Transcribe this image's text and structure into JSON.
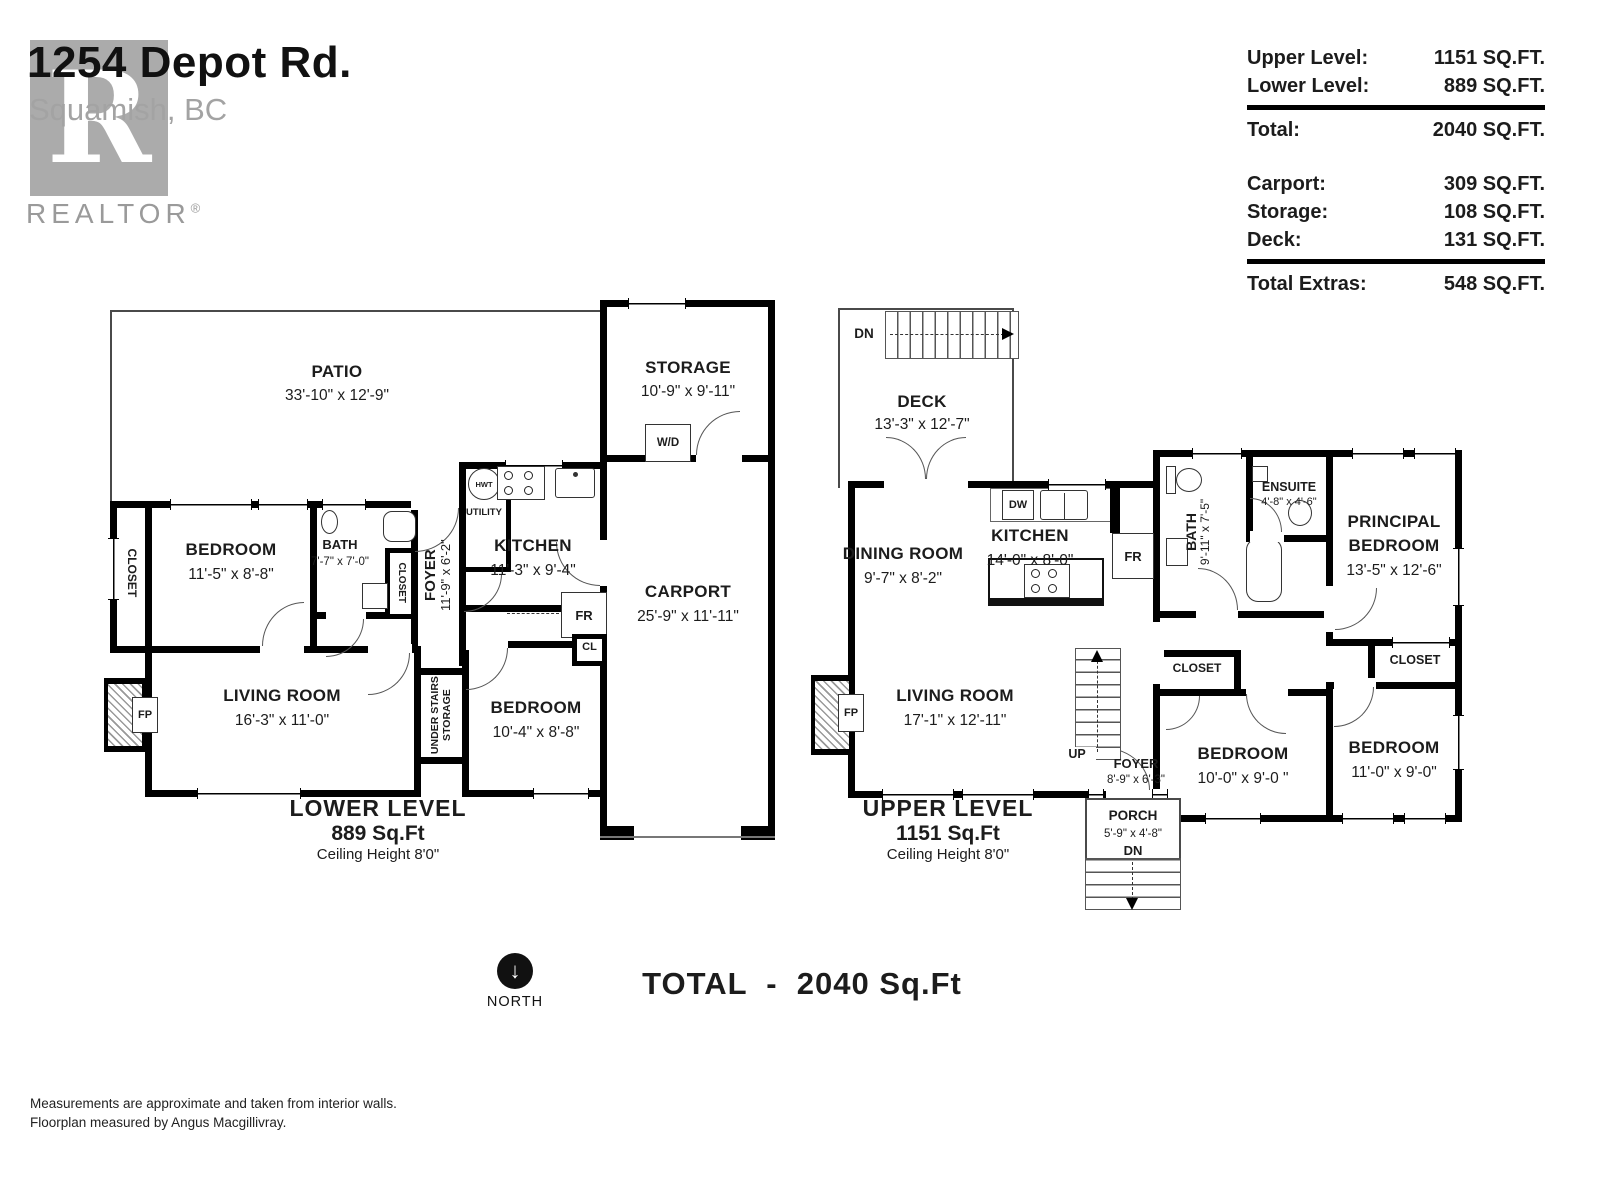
{
  "header": {
    "address_line1": "1254 Depot Rd.",
    "address_line2": "Squamish, BC",
    "logo_letter": "R",
    "realtor_label": "REALTOR",
    "registered_mark": "®"
  },
  "summary": {
    "rows": [
      {
        "label": "Upper Level:",
        "value": "1151 SQ.FT."
      },
      {
        "label": "Lower Level:",
        "value": "889 SQ.FT."
      },
      {
        "label": "Total:",
        "value": "2040 SQ.FT."
      },
      {
        "label": "Carport:",
        "value": "309 SQ.FT."
      },
      {
        "label": "Storage:",
        "value": "108 SQ.FT."
      },
      {
        "label": "Deck:",
        "value": "131 SQ.FT."
      },
      {
        "label": "Total Extras:",
        "value": "548 SQ.FT."
      }
    ]
  },
  "lower": {
    "title": "LOWER LEVEL",
    "sqft": "889 Sq.Ft",
    "ceiling": "Ceiling Height 8'0\"",
    "patio": {
      "name": "PATIO",
      "dims": "33'-10\" x 12'-9\""
    },
    "storage": {
      "name": "STORAGE",
      "dims": "10'-9\" x 9'-11\""
    },
    "wd": "W/D",
    "closet_left": "CLOSET",
    "bedroom1": {
      "name": "BEDROOM",
      "dims": "11'-5\" x 8'-8\""
    },
    "bath": {
      "name": "BATH",
      "dims": "7'-7\" x 7'-0\""
    },
    "closet_small": "CLOSET",
    "foyer": {
      "name": "FOYER",
      "dims": "11'-9\" x 6'-2\""
    },
    "utility": {
      "name": "UTILITY",
      "hwt": "HWT"
    },
    "kitchen": {
      "name": "KITCHEN",
      "dims": "11'-3\" x 9'-4\""
    },
    "carport": {
      "name": "CARPORT",
      "dims": "25'-9\" x 11'-11\""
    },
    "living": {
      "name": "LIVING ROOM",
      "dims": "16'-3\" x 11'-0\""
    },
    "fp": "FP",
    "understairs_line1": "UNDER STAIRS",
    "understairs_line2": "STORAGE",
    "bedroom2": {
      "name": "BEDROOM",
      "dims": "10'-4\" x 8'-8\""
    },
    "fr": "FR",
    "cl": "CL"
  },
  "upper": {
    "title": "UPPER LEVEL",
    "sqft": "1151 Sq.Ft",
    "ceiling": "Ceiling Height 8'0\"",
    "deck": {
      "name": "DECK",
      "dims": "13'-3\" x 12'-7\"",
      "dn": "DN"
    },
    "dining": {
      "name": "DINING ROOM",
      "dims": "9'-7\" x 8'-2\""
    },
    "kitchen": {
      "name": "KITCHEN",
      "dims": "14'-0\" x 8'-0\"",
      "dw": "DW",
      "fr": "FR"
    },
    "bath": {
      "name": "BATH",
      "dims": "9'-11\" x 7'-5\""
    },
    "ensuite": {
      "name": "ENSUITE",
      "dims": "4'-8\" x 4'-6\""
    },
    "principal": {
      "name_line1": "PRINCIPAL",
      "name_line2": "BEDROOM",
      "dims": "13'-5\" x 12'-6\""
    },
    "living": {
      "name": "LIVING ROOM",
      "dims": "17'-1\" x 12'-11\""
    },
    "fp": "FP",
    "stairs_up": "UP",
    "foyer": {
      "name": "FOYER",
      "dims": "8'-9\" x 6'-3\""
    },
    "closet1": "CLOSET",
    "closet2": "CLOSET",
    "bedroom1": {
      "name": "BEDROOM",
      "dims": "10'-0\" x 9'-0 \""
    },
    "bedroom2": {
      "name": "BEDROOM",
      "dims": "11'-0\" x 9'-0\""
    },
    "porch": {
      "name": "PORCH",
      "dims": "5'-9\" x 4'-8\"",
      "dn": "DN"
    }
  },
  "footer": {
    "north": "NORTH",
    "total": "TOTAL  -  2040 Sq.Ft",
    "note1": "Measurements are approximate and taken from interior walls.",
    "note2": "Floorplan measured by Angus Macgillivray."
  }
}
